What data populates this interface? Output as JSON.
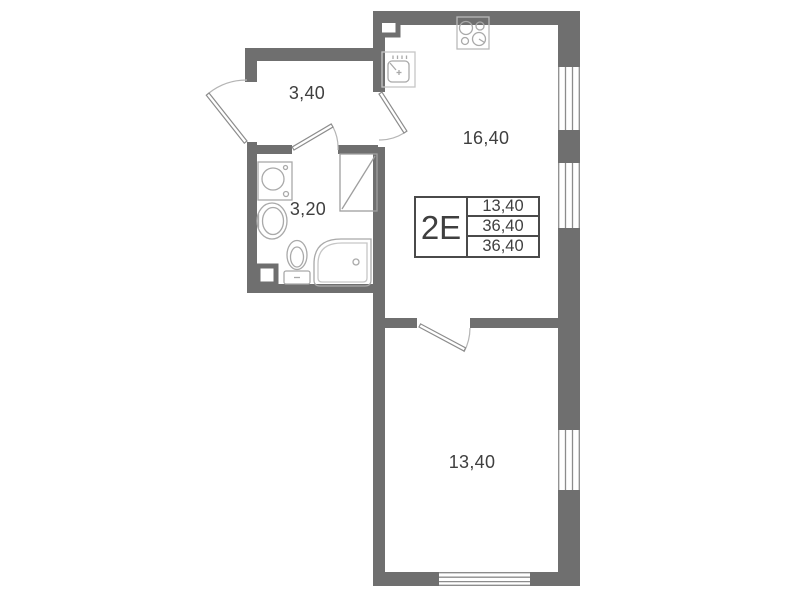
{
  "plan": {
    "unit_label": "2Е",
    "info_table": {
      "rows": [
        "13,40",
        "36,40",
        "36,40"
      ]
    },
    "rooms": [
      {
        "name": "hallway",
        "area": "3,40"
      },
      {
        "name": "bathroom",
        "area": "3,20"
      },
      {
        "name": "kitchen-living-room",
        "area": "16,40"
      },
      {
        "name": "bedroom",
        "area": "13,40"
      }
    ],
    "icons": {
      "stove-icon": "four-burner-circles",
      "kitchen-sink-icon": "square-basin-with-faucet",
      "washing-machine-icon": "square-with-drum-circle",
      "bathroom-sink-icon": "oval-basin",
      "toilet-icon": "bowl-with-tank",
      "corner-bathtub-icon": "rounded-corner-tub",
      "wardrobe-icon": "rectangle-with-diagonal",
      "window-icon": "parallel-glazing-lines",
      "door-icon": "leaf-with-swing-arc"
    },
    "colors": {
      "wall": "#6f6f6f",
      "fixture_line": "#a9a9a9",
      "door_line": "#8c8c8c",
      "table_border": "#4a4a4a",
      "text": "#3f3f3f",
      "background": "#ffffff"
    }
  }
}
